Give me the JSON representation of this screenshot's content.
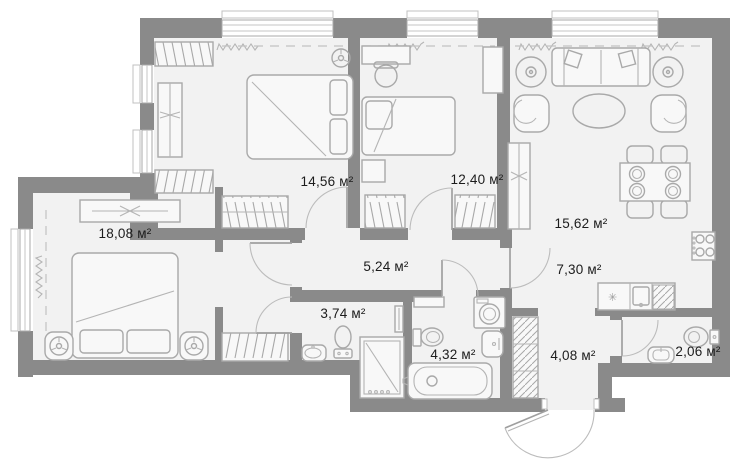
{
  "page": {
    "title": "Apartment floor plan",
    "area_unit": "м²"
  },
  "plan": {
    "width": 750,
    "height": 475,
    "counter_symbol": "✳",
    "colors": {
      "wall": "#8a8a8a",
      "floor": "#f2f2f2",
      "furniture_stroke": "#a9a9a9",
      "label_text": "#1c1c1c",
      "background": "#ffffff"
    },
    "rooms": [
      {
        "id": "bedroom-1",
        "label": "18,08 м²",
        "x": 125,
        "y": 238
      },
      {
        "id": "bedroom-2",
        "label": "14,56 м²",
        "x": 327,
        "y": 186
      },
      {
        "id": "bedroom-3",
        "label": "12,40 м²",
        "x": 477,
        "y": 184
      },
      {
        "id": "living-room",
        "label": "15,62 м²",
        "x": 581,
        "y": 228
      },
      {
        "id": "hallway",
        "label": "5,24 м²",
        "x": 386,
        "y": 271
      },
      {
        "id": "kitchen",
        "label": "7,30 м²",
        "x": 579,
        "y": 274
      },
      {
        "id": "wc-shower",
        "label": "3,74 м²",
        "x": 343,
        "y": 318
      },
      {
        "id": "bathroom",
        "label": "4,32 м²",
        "x": 453,
        "y": 359
      },
      {
        "id": "entry-hall",
        "label": "4,08 м²",
        "x": 573,
        "y": 360
      },
      {
        "id": "wc",
        "label": "2,06 м²",
        "x": 698,
        "y": 356
      }
    ]
  }
}
